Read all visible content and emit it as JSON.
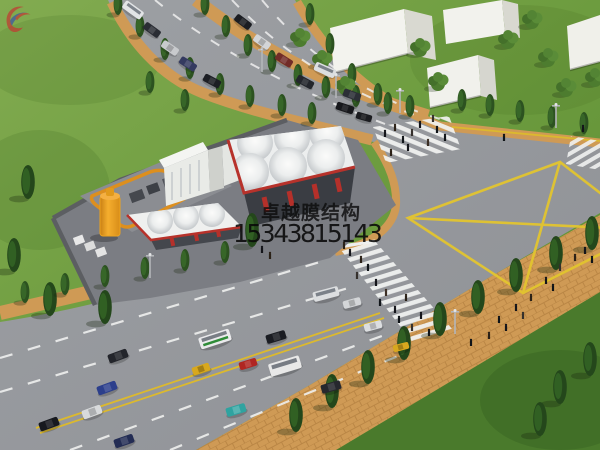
{
  "watermark": {
    "brand_text": "卓越膜结构",
    "phone_number": "15343815143",
    "logo_colors": {
      "red": "#c23a32",
      "blue": "#3c55a6"
    }
  },
  "palette": {
    "grass": "#6d9c3f",
    "grass_dark": "#4a7a2c",
    "road": "#96989d",
    "sidewalk_tan": "#cf9a55",
    "road_marking_yellow": "#e3c52f",
    "lane_marking_white": "#eeefee",
    "canopy_white": "#f5f6f4",
    "canopy_trim_red": "#b7322b",
    "tank_orange": "#eda31f",
    "tree_dark_green": "#2c5220",
    "building_white": "#f3f3ee"
  }
}
